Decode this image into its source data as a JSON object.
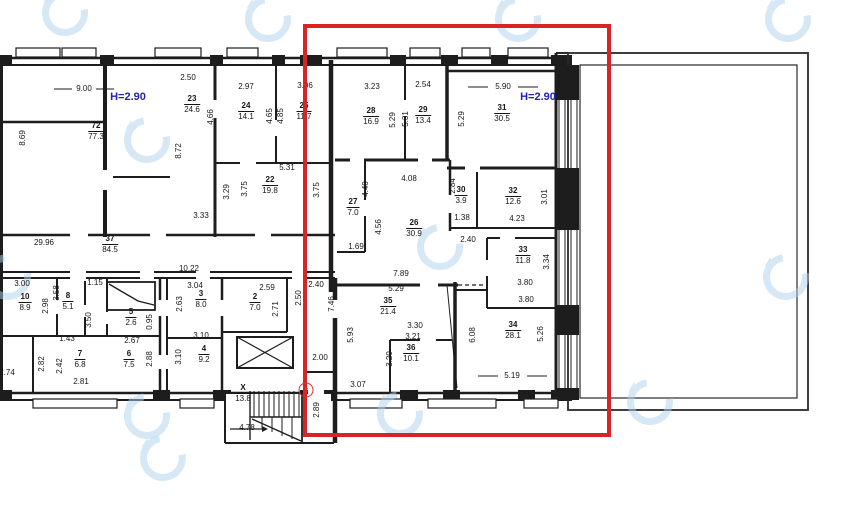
{
  "colors": {
    "highlight_red": "#d92424",
    "height_text_blue": "#2222b4",
    "wall_black": "#1d1d1d",
    "watermark_blue": "#aed3ec"
  },
  "height_labels": [
    {
      "text": "H=2.90",
      "x": 128,
      "y": 97
    },
    {
      "text": "H=2.90",
      "x": 538,
      "y": 97
    }
  ],
  "entrance_badge": {
    "text": "3"
  },
  "rooms": [
    {
      "number": "72",
      "area": "77.3",
      "x": 96,
      "y": 127
    },
    {
      "number": "23",
      "area": "24.6",
      "x": 192,
      "y": 100
    },
    {
      "number": "24",
      "area": "14.1",
      "x": 246,
      "y": 107
    },
    {
      "number": "25",
      "area": "11.7",
      "x": 304,
      "y": 107
    },
    {
      "number": "22",
      "area": "19.8",
      "x": 270,
      "y": 181
    },
    {
      "number": "37",
      "area": "84.5",
      "x": 110,
      "y": 240
    },
    {
      "number": "28",
      "area": "16.9",
      "x": 371,
      "y": 112
    },
    {
      "number": "29",
      "area": "13.4",
      "x": 423,
      "y": 111
    },
    {
      "number": "31",
      "area": "30.5",
      "x": 502,
      "y": 109
    },
    {
      "number": "30",
      "area": "3.9",
      "x": 461,
      "y": 191
    },
    {
      "number": "32",
      "area": "12.6",
      "x": 513,
      "y": 192
    },
    {
      "number": "27",
      "area": "7.0",
      "x": 353,
      "y": 203
    },
    {
      "number": "26",
      "area": "30.9",
      "x": 414,
      "y": 224
    },
    {
      "number": "33",
      "area": "11.8",
      "x": 523,
      "y": 251
    },
    {
      "number": "35",
      "area": "21.4",
      "x": 388,
      "y": 302
    },
    {
      "number": "36",
      "area": "10.1",
      "x": 411,
      "y": 349
    },
    {
      "number": "34",
      "area": "28.1",
      "x": 513,
      "y": 326
    },
    {
      "number": "10",
      "area": "8.9",
      "x": 25,
      "y": 298
    },
    {
      "number": "8",
      "area": "5.1",
      "x": 68,
      "y": 297
    },
    {
      "number": "5",
      "area": "2.6",
      "x": 131,
      "y": 313
    },
    {
      "number": "3",
      "area": "8.0",
      "x": 201,
      "y": 295
    },
    {
      "number": "2",
      "area": "7.0",
      "x": 255,
      "y": 298
    },
    {
      "number": "7",
      "area": "6.8",
      "x": 80,
      "y": 355
    },
    {
      "number": "6",
      "area": "7.5",
      "x": 129,
      "y": 355
    },
    {
      "number": "4",
      "area": "9.2",
      "x": 204,
      "y": 350
    },
    {
      "number": "X",
      "area": "13.8",
      "x": 243,
      "y": 389
    }
  ],
  "dimensions": [
    {
      "text": "9.00",
      "x": 84,
      "y": 89
    },
    {
      "text": "2.50",
      "x": 188,
      "y": 78
    },
    {
      "text": "2.97",
      "x": 246,
      "y": 87
    },
    {
      "text": "3.06",
      "x": 305,
      "y": 86
    },
    {
      "text": "3.23",
      "x": 372,
      "y": 87
    },
    {
      "text": "2.54",
      "x": 423,
      "y": 85
    },
    {
      "text": "5.90",
      "x": 503,
      "y": 87
    },
    {
      "text": "8.69",
      "x": 23,
      "y": 138,
      "v": true
    },
    {
      "text": "8.72",
      "x": 179,
      "y": 151,
      "v": true
    },
    {
      "text": "4.66",
      "x": 211,
      "y": 117,
      "v": true
    },
    {
      "text": "4.65",
      "x": 270,
      "y": 116,
      "v": true
    },
    {
      "text": "4.85",
      "x": 281,
      "y": 116,
      "v": true
    },
    {
      "text": "5.29",
      "x": 393,
      "y": 120,
      "v": true
    },
    {
      "text": "5.31",
      "x": 406,
      "y": 119,
      "v": true
    },
    {
      "text": "5.29",
      "x": 462,
      "y": 119,
      "v": true
    },
    {
      "text": "5.31",
      "x": 287,
      "y": 168
    },
    {
      "text": "3.29",
      "x": 227,
      "y": 192,
      "v": true
    },
    {
      "text": "3.75",
      "x": 245,
      "y": 189,
      "v": true
    },
    {
      "text": "3.75",
      "x": 317,
      "y": 190,
      "v": true
    },
    {
      "text": "3.33",
      "x": 201,
      "y": 216
    },
    {
      "text": "29.96",
      "x": 44,
      "y": 243
    },
    {
      "text": "10.22",
      "x": 189,
      "y": 269
    },
    {
      "text": "4.08",
      "x": 409,
      "y": 179
    },
    {
      "text": "4.40",
      "x": 366,
      "y": 189,
      "v": true
    },
    {
      "text": "2.84",
      "x": 453,
      "y": 186,
      "v": true
    },
    {
      "text": "1.38",
      "x": 462,
      "y": 218
    },
    {
      "text": "4.23",
      "x": 517,
      "y": 219
    },
    {
      "text": "3.01",
      "x": 545,
      "y": 197,
      "v": true
    },
    {
      "text": "4.56",
      "x": 379,
      "y": 227,
      "v": true
    },
    {
      "text": "1.69",
      "x": 356,
      "y": 247
    },
    {
      "text": "2.40",
      "x": 468,
      "y": 240
    },
    {
      "text": "2.40",
      "x": 316,
      "y": 285
    },
    {
      "text": "3.34",
      "x": 547,
      "y": 262,
      "v": true
    },
    {
      "text": "3.80",
      "x": 525,
      "y": 283
    },
    {
      "text": "3.80",
      "x": 526,
      "y": 300
    },
    {
      "text": "7.89",
      "x": 401,
      "y": 274
    },
    {
      "text": "5.29",
      "x": 396,
      "y": 289
    },
    {
      "text": "2.50",
      "x": 299,
      "y": 298,
      "v": true
    },
    {
      "text": "7.46",
      "x": 332,
      "y": 304,
      "v": true
    },
    {
      "text": "5.93",
      "x": 351,
      "y": 335,
      "v": true
    },
    {
      "text": "3.30",
      "x": 415,
      "y": 326
    },
    {
      "text": "3.21",
      "x": 413,
      "y": 337
    },
    {
      "text": "3.20",
      "x": 390,
      "y": 359,
      "v": true
    },
    {
      "text": "6.08",
      "x": 473,
      "y": 335,
      "v": true
    },
    {
      "text": "5.26",
      "x": 541,
      "y": 334,
      "v": true
    },
    {
      "text": "5.19",
      "x": 512,
      "y": 376
    },
    {
      "text": "2.00",
      "x": 320,
      "y": 358
    },
    {
      "text": "3.07",
      "x": 358,
      "y": 385
    },
    {
      "text": "2.89",
      "x": 317,
      "y": 410,
      "v": true
    },
    {
      "text": "4.78",
      "x": 247,
      "y": 428
    },
    {
      "text": "3.00",
      "x": 22,
      "y": 284
    },
    {
      "text": "1.15",
      "x": 95,
      "y": 283
    },
    {
      "text": "3.04",
      "x": 195,
      "y": 286
    },
    {
      "text": "2.59",
      "x": 267,
      "y": 288
    },
    {
      "text": "2.98",
      "x": 46,
      "y": 306,
      "v": true
    },
    {
      "text": "3.58",
      "x": 57,
      "y": 293,
      "v": true
    },
    {
      "text": "3.50",
      "x": 89,
      "y": 320,
      "v": true
    },
    {
      "text": "2.63",
      "x": 180,
      "y": 304,
      "v": true
    },
    {
      "text": "2.71",
      "x": 276,
      "y": 309,
      "v": true
    },
    {
      "text": "1.43",
      "x": 67,
      "y": 339
    },
    {
      "text": "0.95",
      "x": 150,
      "y": 322,
      "v": true
    },
    {
      "text": "2.67",
      "x": 132,
      "y": 341
    },
    {
      "text": "3.10",
      "x": 201,
      "y": 336
    },
    {
      "text": "2.82",
      "x": 42,
      "y": 364,
      "v": true
    },
    {
      "text": "2.42",
      "x": 60,
      "y": 366,
      "v": true
    },
    {
      "text": "2.88",
      "x": 150,
      "y": 359,
      "v": true
    },
    {
      "text": "3.10",
      "x": 179,
      "y": 357,
      "v": true
    },
    {
      "text": "2.81",
      "x": 81,
      "y": 382
    },
    {
      "text": "2.74",
      "x": 7,
      "y": 373
    }
  ],
  "watermarks": [
    {
      "x": 65,
      "y": 13
    },
    {
      "x": 268,
      "y": 19
    },
    {
      "x": 518,
      "y": 19
    },
    {
      "x": 788,
      "y": 19
    },
    {
      "x": 147,
      "y": 140
    },
    {
      "x": 440,
      "y": 247
    },
    {
      "x": 8,
      "y": 277
    },
    {
      "x": 786,
      "y": 277
    },
    {
      "x": 147,
      "y": 416
    },
    {
      "x": 400,
      "y": 414
    },
    {
      "x": 650,
      "y": 402
    },
    {
      "x": 163,
      "y": 458
    }
  ]
}
